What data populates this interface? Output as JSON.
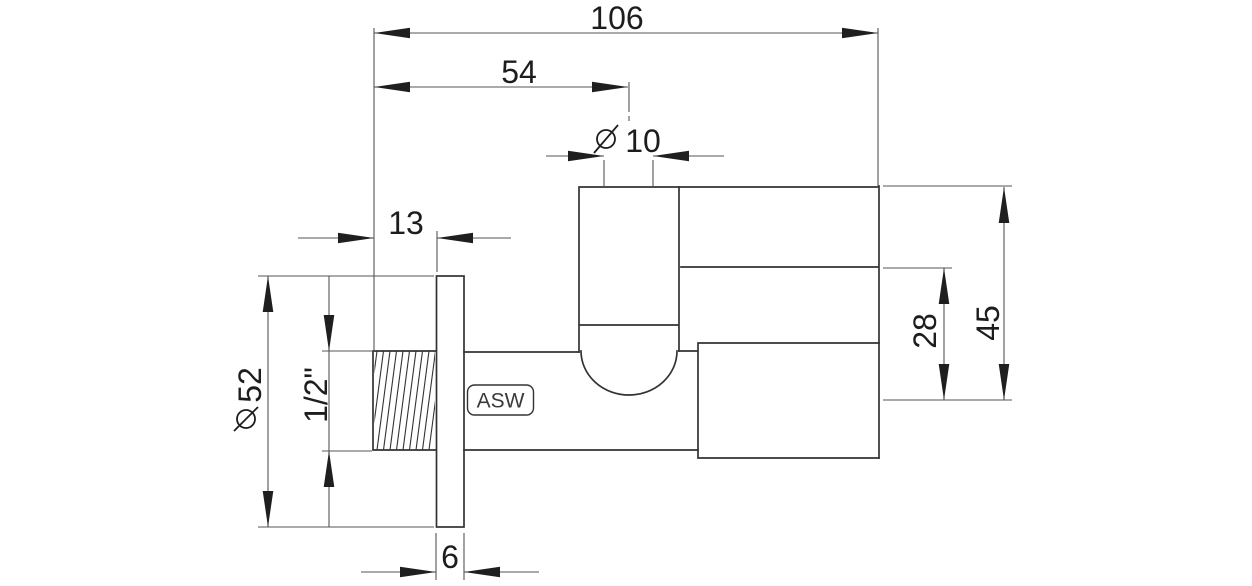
{
  "drawing": {
    "type": "technical-dimension-drawing",
    "subject": "angle-valve-side-view",
    "brand": "ASW",
    "dimensions": {
      "overall_length": "106",
      "inlet_to_axis": "54",
      "outlet_bore": "10",
      "thread_length": "13",
      "rosette_diameter": "52",
      "thread_size": "1/2\"",
      "depth_to_axis": "28",
      "height_to_axis": "45",
      "rosette_thickness": "6"
    },
    "symbols": {
      "diameter": "⌀"
    },
    "colors": {
      "background": "#ffffff",
      "object_line": "#333333",
      "dimension_line": "#555555",
      "arrow": "#1f1f1f",
      "text": "#1d1d1d"
    }
  }
}
